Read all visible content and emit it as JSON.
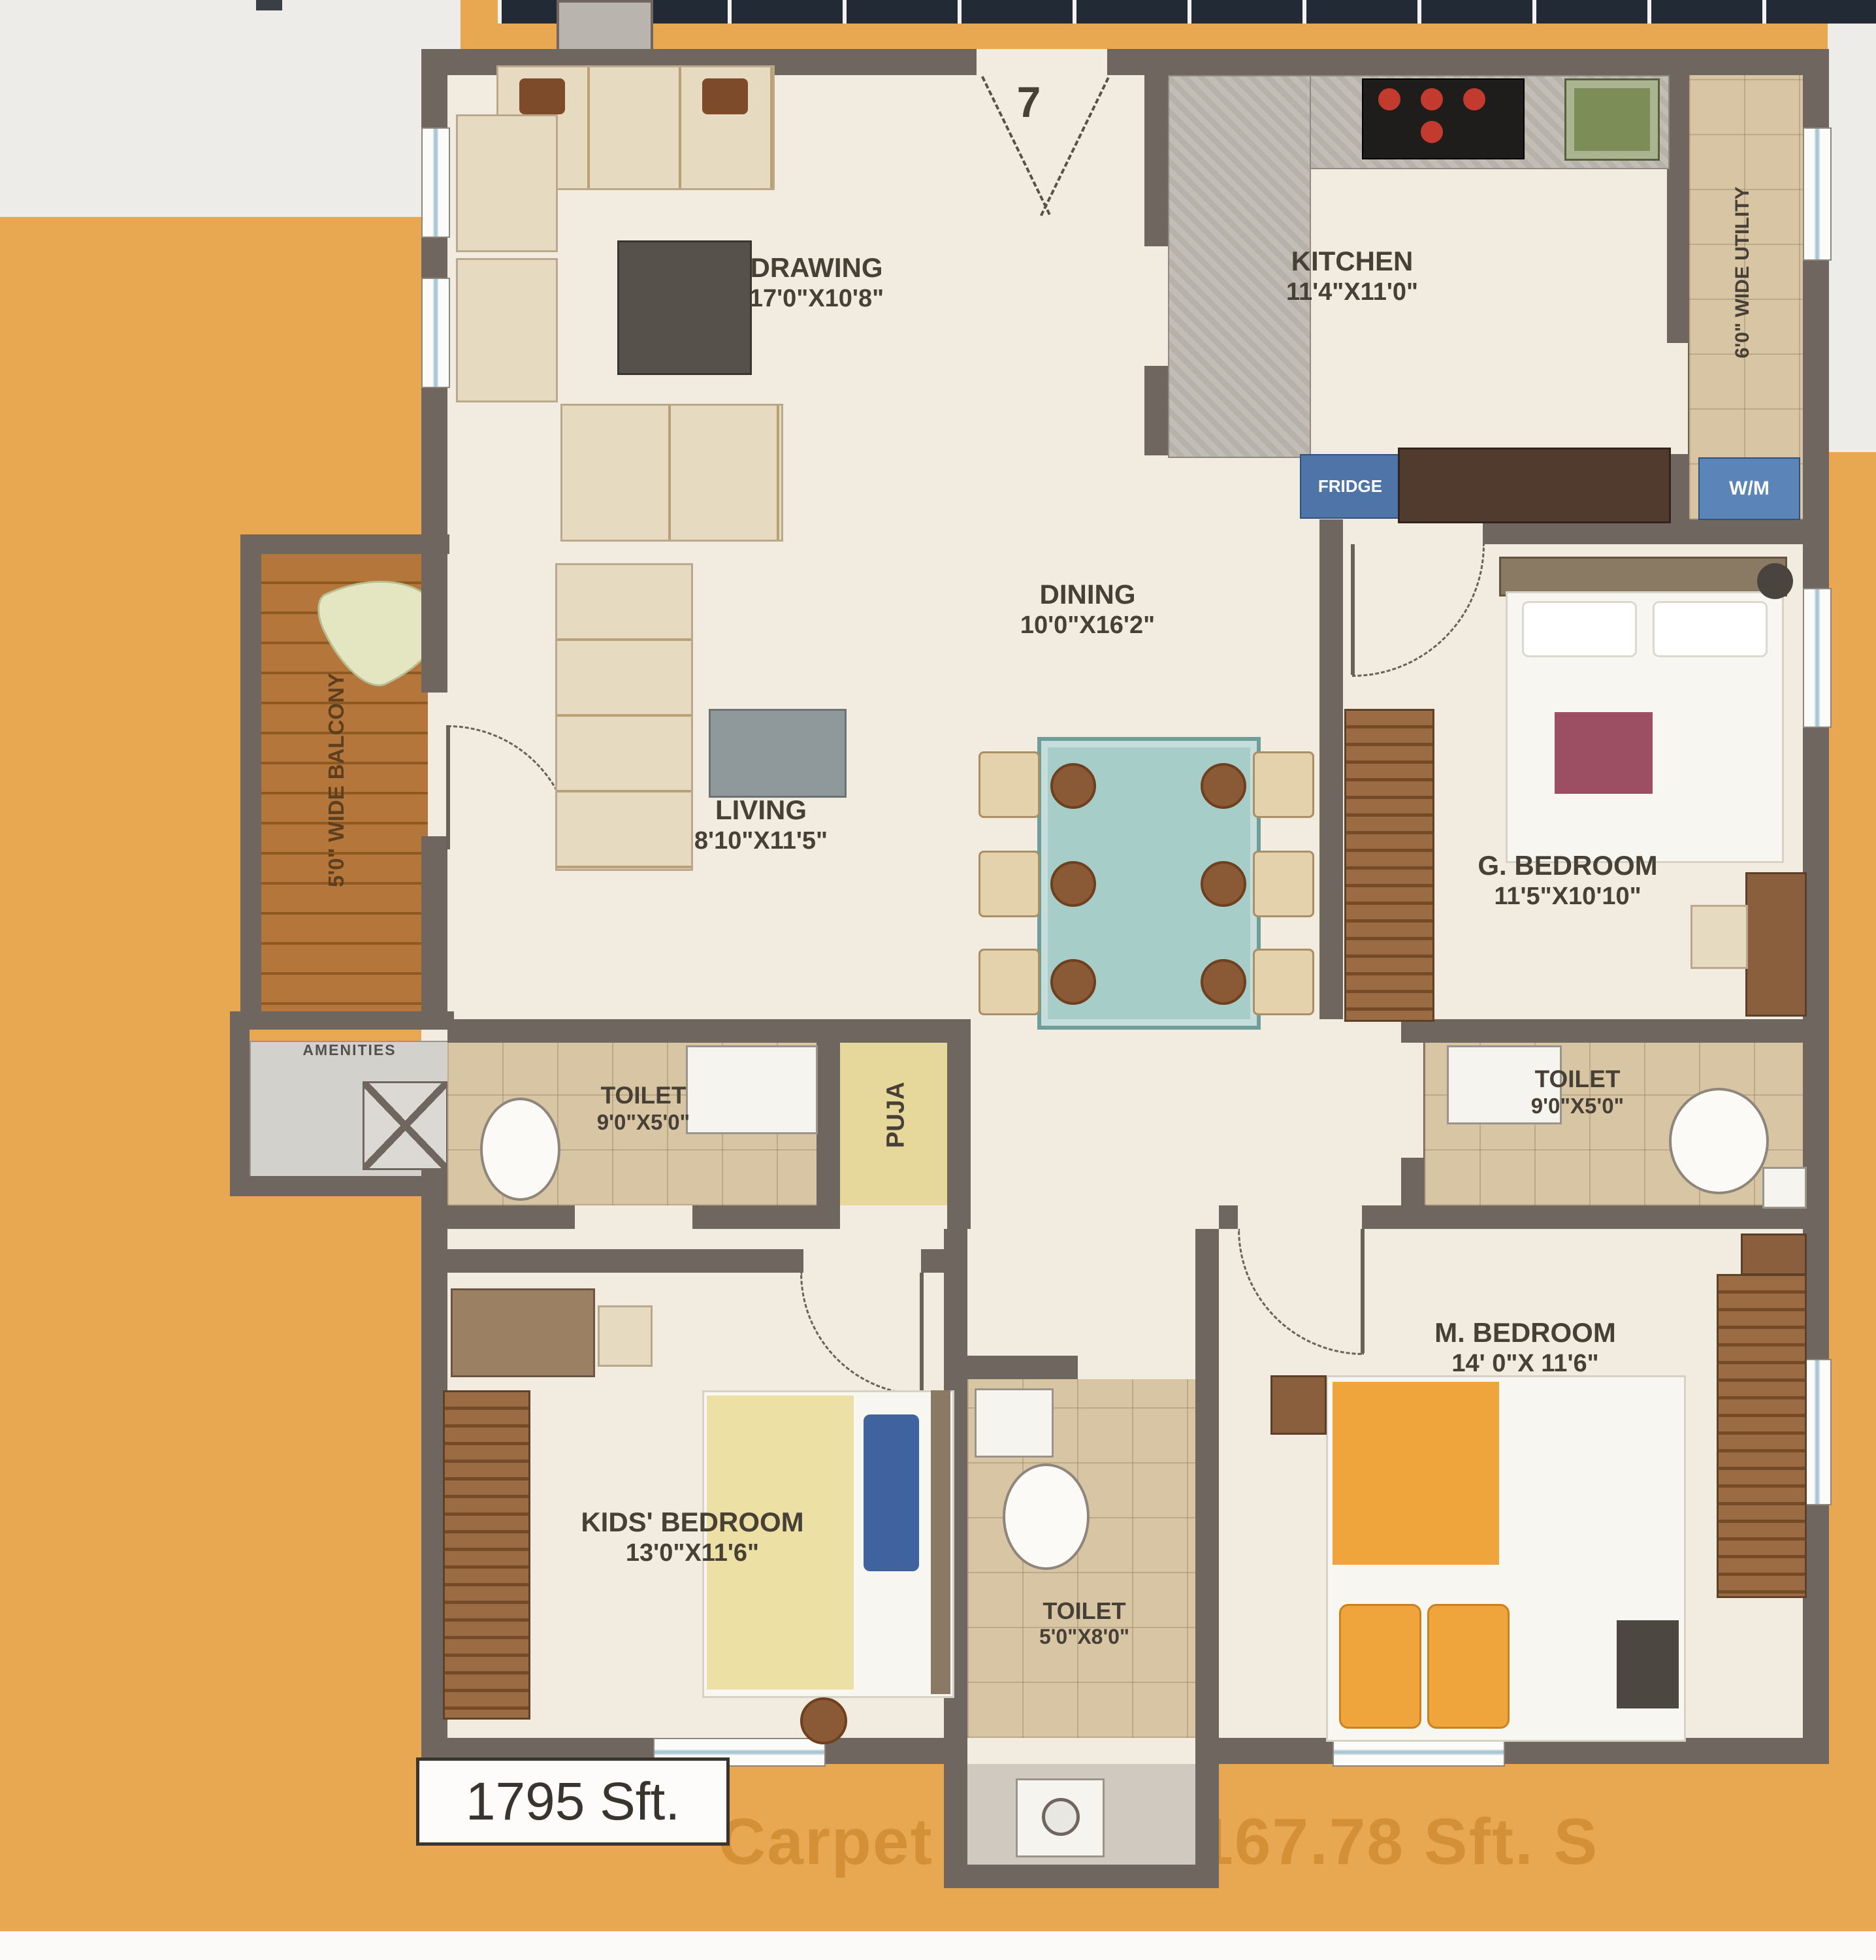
{
  "unit_number": "7",
  "area_badge": "1795 Sft.",
  "watermark": "Carpet Area : 1167.78 Sft. S",
  "rooms": {
    "drawing": {
      "name": "DRAWING",
      "dims": "17'0\"X10'8\""
    },
    "kitchen": {
      "name": "KITCHEN",
      "dims": "11'4\"X11'0\""
    },
    "utility": {
      "name": "6'0\" WIDE UTILITY"
    },
    "balcony": {
      "name": "5'0\" WIDE BALCONY"
    },
    "dining": {
      "name": "DINING",
      "dims": "10'0\"X16'2\""
    },
    "living": {
      "name": "LIVING",
      "dims": "8'10\"X11'5\""
    },
    "g_bedroom": {
      "name": "G. BEDROOM",
      "dims": "11'5\"X10'10\""
    },
    "toilet_left": {
      "name": "TOILET",
      "dims": "9'0\"X5'0\""
    },
    "puja": {
      "name": "PUJA"
    },
    "toilet_right": {
      "name": "TOILET",
      "dims": "9'0\"X5'0\""
    },
    "m_bedroom": {
      "name": "M. BEDROOM",
      "dims": "14' 0\"X 11'6\""
    },
    "kids_bedroom": {
      "name": "KIDS' BEDROOM",
      "dims": "13'0\"X11'6\""
    },
    "toilet_bottom": {
      "name": "TOILET",
      "dims": "5'0\"X8'0\""
    },
    "amenities": {
      "name": "AMENITIES"
    }
  },
  "appliances": {
    "fridge": "FRIDGE",
    "washing_machine": "W/M"
  },
  "colors": {
    "background": "#E8A851",
    "wall": "#6F6660",
    "floor": "#F1ECDF",
    "balcony_wood": "#B5763C",
    "dining_table": "#A7CDC9",
    "bed_accent_orange": "#F0A43C",
    "label_text": "#474036"
  }
}
